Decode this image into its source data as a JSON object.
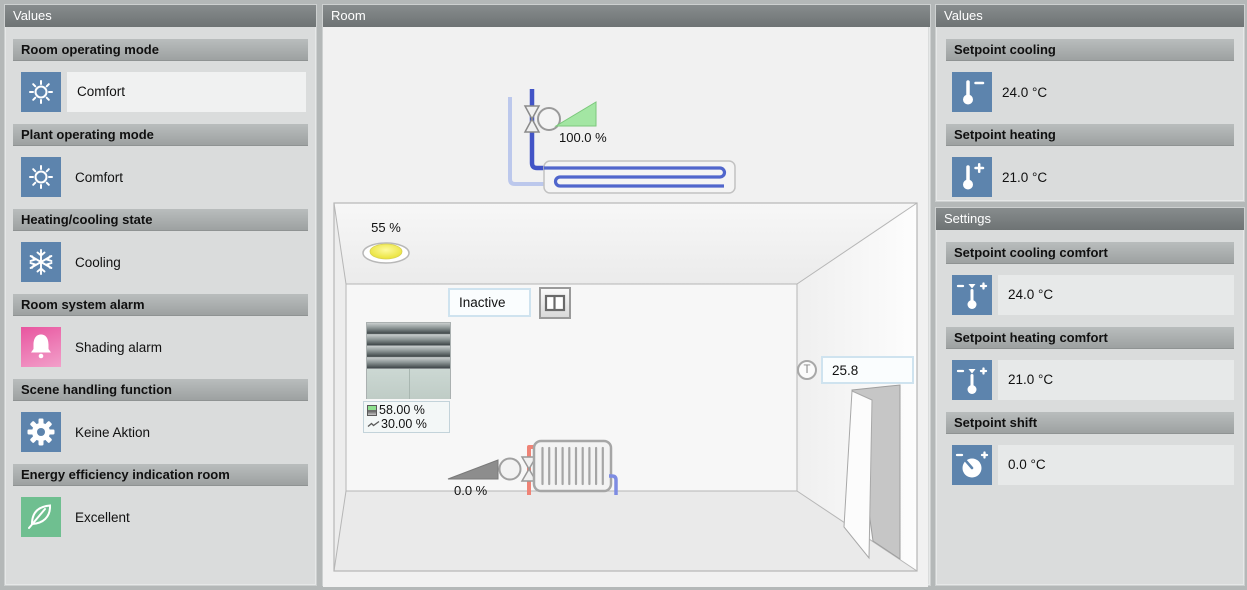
{
  "left_panel": {
    "title": "Values",
    "sections": [
      {
        "label": "Room operating mode",
        "value": "Comfort",
        "icon": "sun-icon"
      },
      {
        "label": "Plant operating mode",
        "value": "Comfort",
        "icon": "sun-icon"
      },
      {
        "label": "Heating/cooling state",
        "value": "Cooling",
        "icon": "snowflake-icon"
      },
      {
        "label": "Room system alarm",
        "value": "Shading alarm",
        "icon": "alarm-bell-icon"
      },
      {
        "label": "Scene handling function",
        "value": "Keine Aktion",
        "icon": "gear-icon"
      },
      {
        "label": "Energy efficiency indication room",
        "value": "Excellent",
        "icon": "leaf-icon"
      }
    ]
  },
  "room_panel": {
    "title": "Room",
    "chilled_beam_valve_position": "100.0 %",
    "light_level": "55 %",
    "window_state": "Inactive",
    "window_button_icon": "window-pane-icon",
    "blind_position": "58.00 %",
    "blind_slat_angle": "30.00 %",
    "radiator_valve_position": "0.0 %",
    "temperature_sensor_label": "T",
    "room_temperature": "25.8"
  },
  "right_values_panel": {
    "title": "Values",
    "sections": [
      {
        "label": "Setpoint cooling",
        "value": "24.0 °C",
        "icon": "thermometer-minus-icon"
      },
      {
        "label": "Setpoint heating",
        "value": "21.0 °C",
        "icon": "thermometer-plus-icon"
      }
    ]
  },
  "settings_panel": {
    "title": "Settings",
    "sections": [
      {
        "label": "Setpoint cooling comfort",
        "value": "24.0 °C",
        "icon": "thermometer-adjust-icon"
      },
      {
        "label": "Setpoint heating comfort",
        "value": "21.0 °C",
        "icon": "thermometer-adjust-icon"
      },
      {
        "label": "Setpoint shift",
        "value": "0.0 °C",
        "icon": "dial-icon"
      }
    ]
  },
  "colors": {
    "icon_blue": "#5d84ad",
    "alarm_pink": "#e8559f",
    "eco_green": "#6fbf90",
    "supply_pipe_blue": "#4254c6",
    "return_pipe_light_blue": "#bcc8ec",
    "heating_pipe_red": "#ef8376",
    "valve_open_green": "#a3e6a3",
    "valve_closed_gray": "#8d8d8d",
    "panel_header_gray": "#6e7374"
  }
}
